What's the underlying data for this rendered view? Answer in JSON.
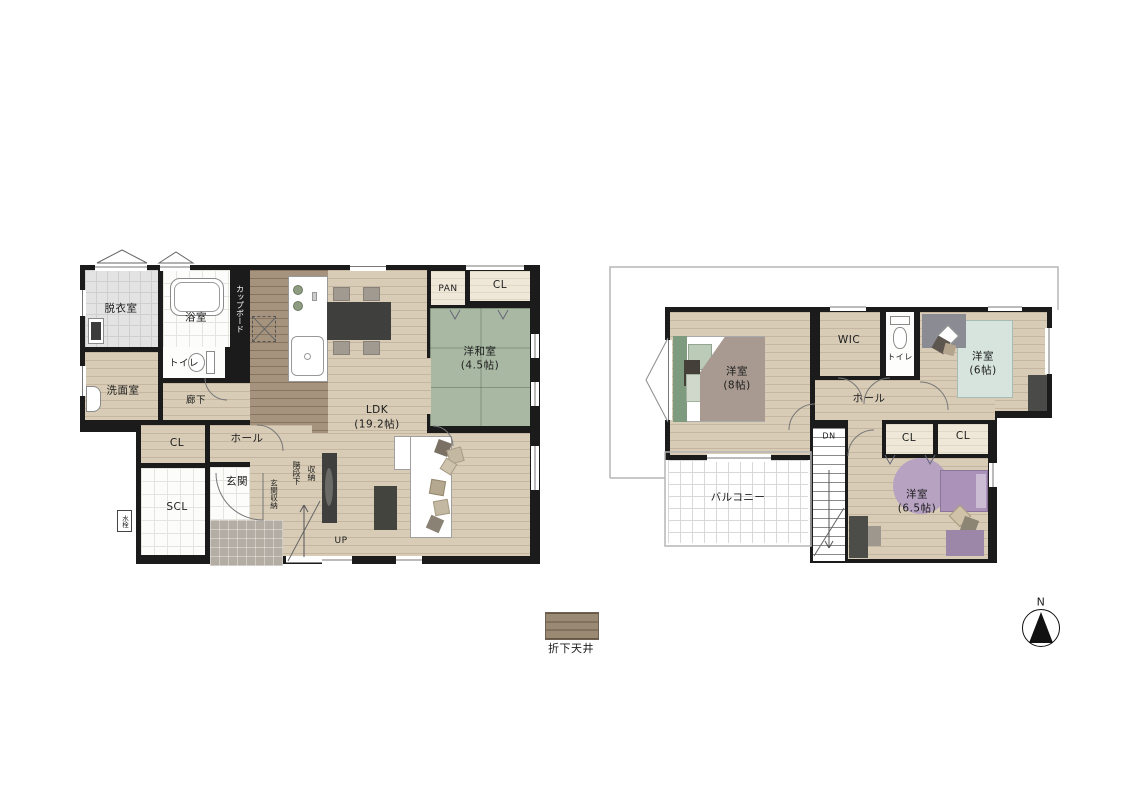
{
  "floor1": {
    "dressing_room": "脱衣室",
    "bathroom": "浴室",
    "cupboard": "カップボード",
    "toilet": "トイレ",
    "washroom": "洗面室",
    "corridor": "廊下",
    "pantry": "PAN",
    "closet_top": "CL",
    "tatami_room": "洋和室",
    "tatami_room_size": "(4.5帖)",
    "ldk": "LDK",
    "ldk_size": "(19.2帖)",
    "closet_mid": "CL",
    "hall": "ホール",
    "shoe_closet": "SCL",
    "entrance": "玄関",
    "entrance_storage": "玄関収納",
    "under_stair_storage": "階段下収納",
    "up": "UP",
    "faucet": "水栓"
  },
  "floor2": {
    "bedroom8": "洋室",
    "bedroom8_size": "(8帖)",
    "wic": "WIC",
    "toilet": "トイレ",
    "bedroom6": "洋室",
    "bedroom6_size": "(6帖)",
    "hall": "ホール",
    "closet_a": "CL",
    "closet_b": "CL",
    "balcony": "バルコニー",
    "dn": "DN",
    "bedroom65": "洋室",
    "bedroom65_size": "(6.5帖)"
  },
  "legend": {
    "lowered_ceiling": "折下天井"
  },
  "compass": {
    "north": "N"
  },
  "colors": {
    "wall": "#1b1b1b",
    "wood_light": "#d8ccb6",
    "wood_dark": "#a5937d",
    "tatami": "#a9b8a3",
    "tile": "#e3e3e3",
    "porch": "#b3ada4",
    "cream": "#efe8d8",
    "bed_green": "#7e9a7f",
    "bed_blue": "#d7e4de",
    "bed_purple": "#ab92b8",
    "rug_purple": "#b7a2c2",
    "furniture_dark": "#3f3f3d",
    "legend_swatch": "#9a8a74"
  }
}
